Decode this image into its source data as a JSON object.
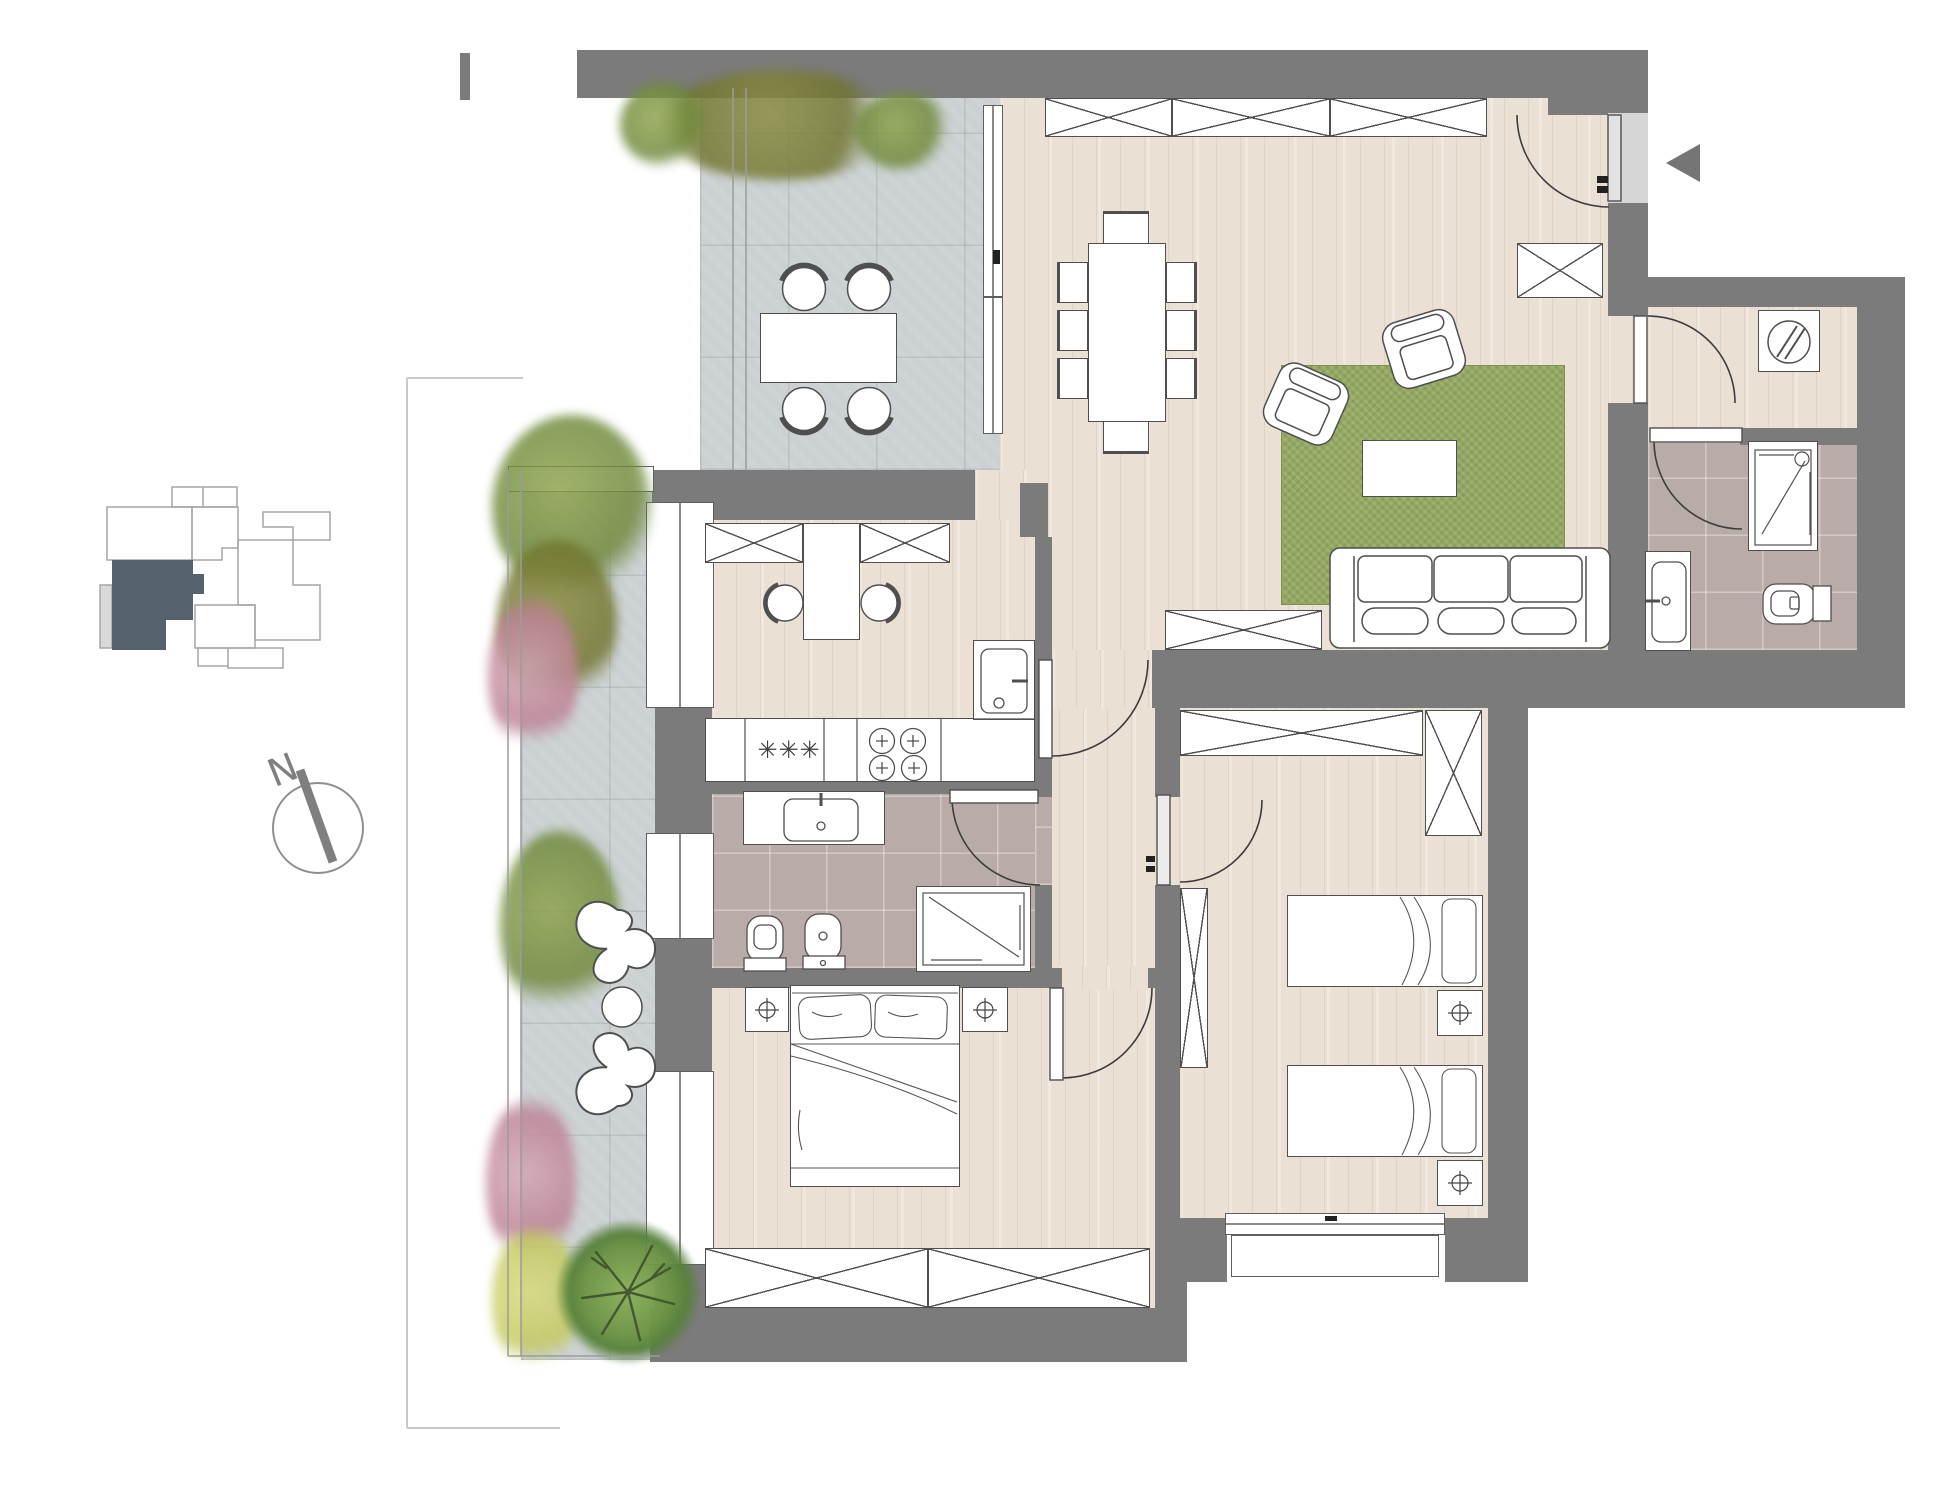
{
  "title": "apartment-floor-plan",
  "labels": {
    "north": "N",
    "freezer_symbol": "✳✳✳"
  },
  "palette": {
    "wall": "#7b7b7b",
    "door-opening": "#d6d6d6",
    "wood": "#ebe0d4",
    "stone": "#cbd0d2",
    "bath-tile": "#b9aca8",
    "rug": "#95aa62",
    "outline": "#4f4f4f",
    "foliage-green": "#76923d",
    "foliage-olive": "#84863a",
    "foliage-pink": "#c795a3",
    "foliage-yellow": "#ccd16b",
    "keymap-unit": "#56616e",
    "keymap-outline": "#a6a6a6",
    "compass": "#7f7f7f",
    "arrow": "#757575"
  },
  "key_map": {
    "highlighted_unit_color": "#56616e"
  },
  "compass": {
    "label": "N"
  },
  "entry_arrow_direction": "left",
  "rooms": [
    {
      "id": "living-dining-room",
      "floor": "wood",
      "furniture": [
        "wardrobe-row-3-modules",
        "dining-table-8-seats",
        "green-rug",
        "coffee-table",
        "armchair",
        "armchair",
        "sofa-3-seat",
        "sideboard",
        "entry-closet"
      ]
    },
    {
      "id": "kitchen",
      "floor": "wood",
      "furniture": [
        "cabinet",
        "cabinet",
        "breakfast-table",
        "chair",
        "chair",
        "counter-with-freezer",
        "hob-4-burners",
        "sink"
      ]
    },
    {
      "id": "hallway",
      "floor": "wood",
      "furniture": []
    },
    {
      "id": "laundry-hall",
      "floor": "wood",
      "furniture": [
        "washing-machine"
      ]
    },
    {
      "id": "bathroom-1",
      "floor": "tile",
      "furniture": [
        "shower",
        "washbasin",
        "toilet"
      ]
    },
    {
      "id": "bathroom-2",
      "floor": "tile",
      "furniture": [
        "vanity-washbasin",
        "toilet",
        "bidet",
        "shower"
      ]
    },
    {
      "id": "master-bedroom",
      "floor": "wood",
      "furniture": [
        "double-bed",
        "nightstand",
        "nightstand",
        "wardrobe-long"
      ]
    },
    {
      "id": "kids-bedroom",
      "floor": "wood",
      "furniture": [
        "wardrobe-top",
        "wardrobe-corner",
        "wardrobe-side",
        "single-bed",
        "single-bed",
        "nightstand",
        "nightstand"
      ]
    },
    {
      "id": "terrace",
      "floor": "stone",
      "furniture": [
        "outdoor-dining-table",
        "outdoor-chair",
        "outdoor-chair",
        "outdoor-chair",
        "outdoor-chair",
        "lounge-chair",
        "lounge-chair",
        "side-table",
        "tree",
        "shrubs"
      ]
    }
  ]
}
